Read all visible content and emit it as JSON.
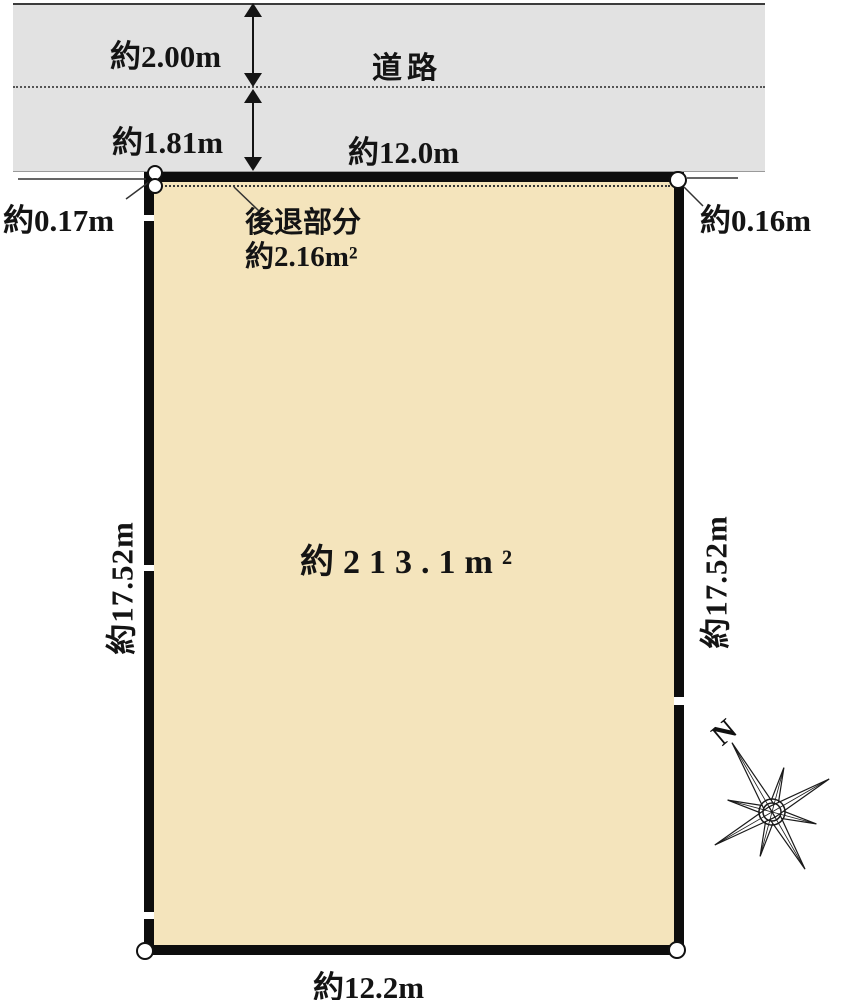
{
  "road": {
    "name": "道路",
    "upper_depth": "約2.00m",
    "lower_depth": "約1.81m",
    "frontage": "約12.0m"
  },
  "plot": {
    "area": "約213.1m²",
    "setback_title": "後退部分",
    "setback_area": "約2.16m²",
    "offset_left": "約0.17m",
    "offset_right": "約0.16m",
    "depth_left": "約17.52m",
    "depth_right": "約17.52m",
    "bottom_width": "約12.2m"
  },
  "compass": {
    "north": "N"
  },
  "colors": {
    "road_fill": "#e2e2e2",
    "plot_fill": "#f4e4bc",
    "line": "#141414"
  }
}
